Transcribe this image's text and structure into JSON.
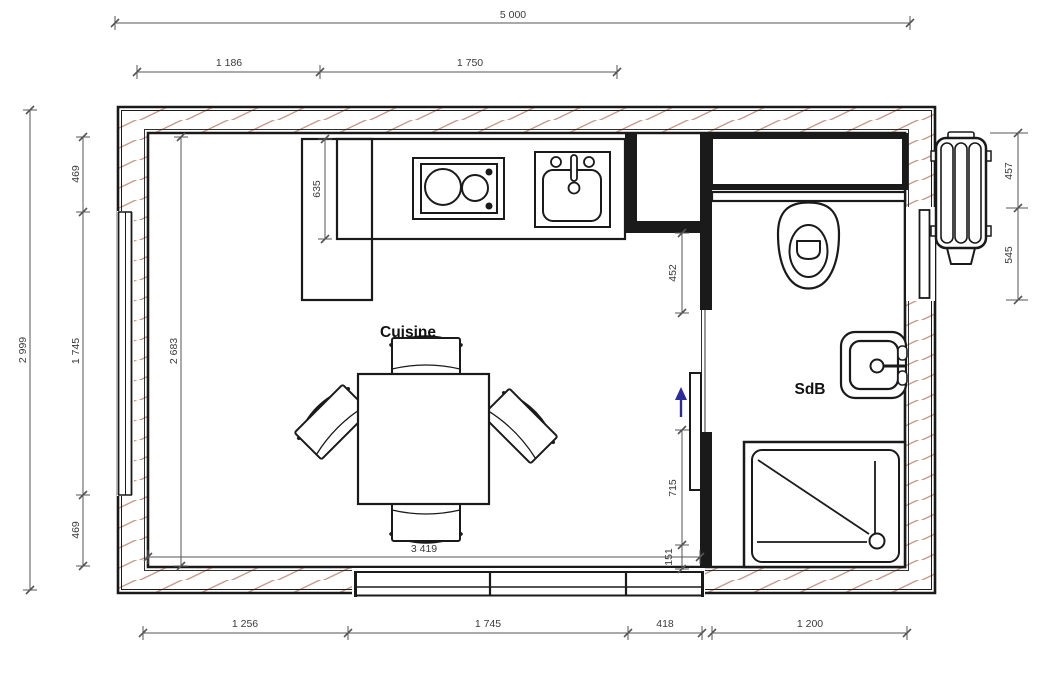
{
  "plan": {
    "room_labels": {
      "kitchen": "Cuisine",
      "bathroom": "SdB"
    },
    "dimensions": {
      "top_overall": "5 000",
      "top_left": "1 186",
      "top_right": "1 750",
      "left_overall": "2 999",
      "left_top": "469",
      "left_middle": "1 745",
      "left_bottom": "469",
      "interior_height": "2 683",
      "counter_depth": "635",
      "partition_top": "452",
      "door_opening": "715",
      "door_bottom": "151",
      "interior_width": "3 419",
      "bottom_1": "1 256",
      "bottom_2": "1 745",
      "bottom_3": "418",
      "bottom_4": "1 200",
      "right_top": "457",
      "right_bottom": "545"
    },
    "colors": {
      "wall_line": "#1a1a1a",
      "hatch": "#c79a8c",
      "dimension": "#3a3a3a",
      "arrow": "#2b2b99",
      "background": "#ffffff"
    }
  }
}
